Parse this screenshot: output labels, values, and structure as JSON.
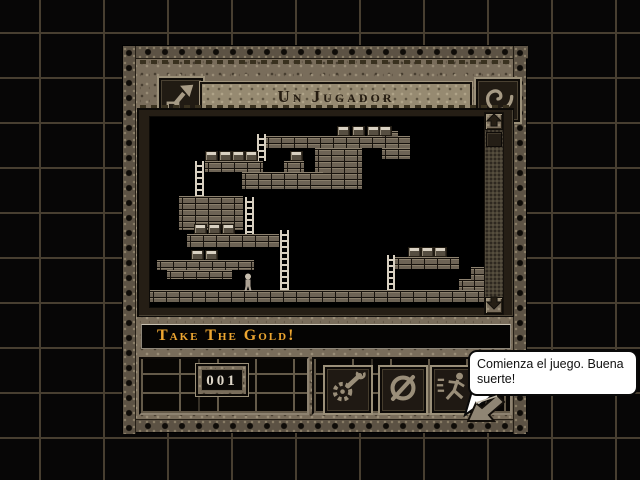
{
  "window": {
    "title": "Un Jugador",
    "header_buttons": [
      {
        "name": "exit",
        "icon": "exit-arrow-icon"
      },
      {
        "name": "options",
        "icon": "spiral-icon"
      }
    ],
    "message_bar": {
      "text": "Take The Gold!"
    },
    "status_panel": {
      "level_counter": "001"
    },
    "control_buttons": [
      {
        "name": "tools",
        "icon": "gear-wrench-icon"
      },
      {
        "name": "abort",
        "icon": "null-sign-icon"
      },
      {
        "name": "run",
        "icon": "running-man-icon"
      }
    ],
    "scrollbar": {
      "orientation": "vertical",
      "up_icon": "arrow-up-icon",
      "down_icon": "arrow-down-icon"
    }
  },
  "tooltip": {
    "text": "Comienza el juego. Buena suerte!"
  },
  "colors": {
    "gold_text": "#eda631",
    "stone_base": "#796d5b",
    "brick": "#6d6355",
    "grid_line": "#473e30",
    "bubble_bg": "#ffffff",
    "icon_light": "#a79b85"
  },
  "level": {
    "viewport_px": {
      "width": 334,
      "height": 190
    },
    "bricks": [
      [
        115,
        19,
        145,
        12
      ],
      [
        165,
        31,
        47,
        41
      ],
      [
        232,
        14,
        16,
        6
      ],
      [
        232,
        31,
        28,
        11
      ],
      [
        55,
        44,
        58,
        11
      ],
      [
        92,
        55,
        81,
        17
      ],
      [
        134,
        44,
        20,
        11
      ],
      [
        29,
        79,
        64,
        34
      ],
      [
        37,
        117,
        92,
        13
      ],
      [
        7,
        143,
        97,
        10
      ],
      [
        17,
        153,
        65,
        9
      ],
      [
        245,
        140,
        64,
        12
      ],
      [
        309,
        162,
        12,
        11
      ],
      [
        321,
        150,
        13,
        23
      ],
      [
        0,
        173,
        334,
        12
      ]
    ],
    "ladders": [
      [
        107,
        17,
        9,
        27
      ],
      [
        45,
        44,
        9,
        35
      ],
      [
        95,
        80,
        9,
        37
      ],
      [
        130,
        113,
        9,
        60
      ],
      [
        237,
        138,
        8,
        35
      ]
    ],
    "gold": [
      [
        187,
        9
      ],
      [
        202,
        9
      ],
      [
        217,
        9
      ],
      [
        229,
        9
      ],
      [
        140,
        34
      ],
      [
        55,
        34
      ],
      [
        69,
        34
      ],
      [
        82,
        34
      ],
      [
        95,
        34
      ],
      [
        44,
        107
      ],
      [
        58,
        107
      ],
      [
        72,
        107
      ],
      [
        41,
        133
      ],
      [
        55,
        133
      ],
      [
        258,
        130
      ],
      [
        271,
        130
      ],
      [
        284,
        130
      ]
    ],
    "player": {
      "x": 92,
      "y": 156,
      "w": 12,
      "h": 17
    }
  }
}
